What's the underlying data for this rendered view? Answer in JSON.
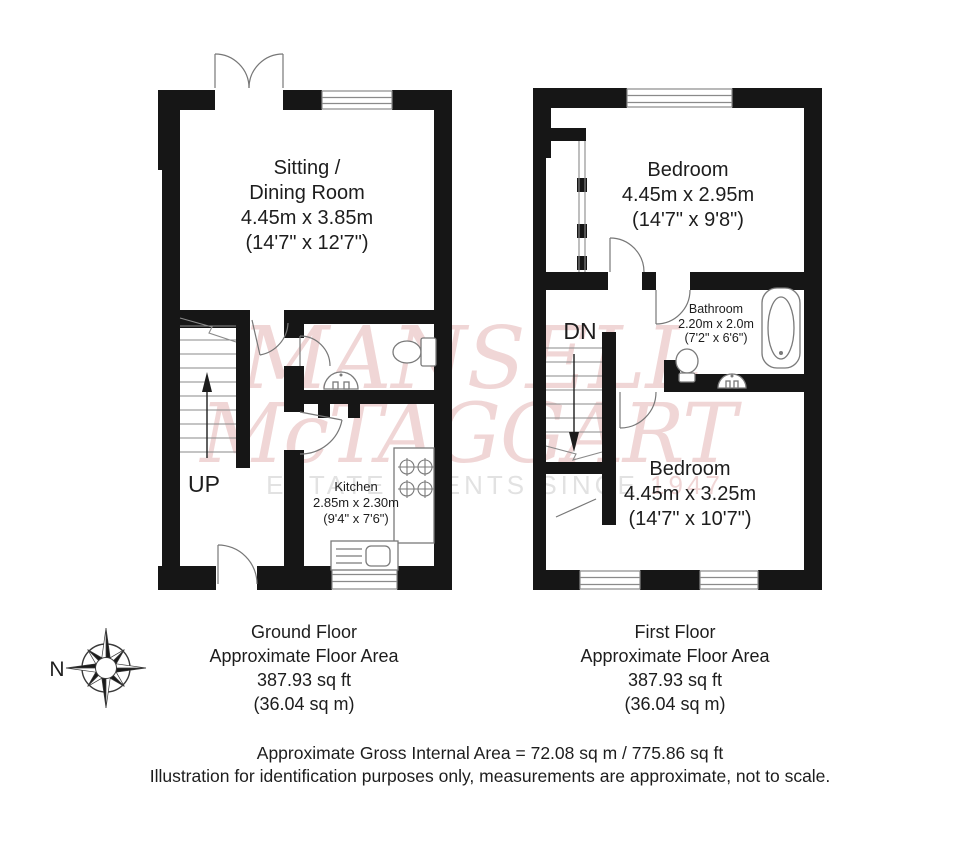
{
  "watermark": {
    "name_line1": "MANSELL",
    "name_line2": "McTAGGART",
    "tagline": "ESTATE AGENTS SINCE ",
    "tagline_year": "1947",
    "name_color": "#f0d6d6",
    "tagline_color": "#e2e2e2"
  },
  "compass": {
    "north_label": "N"
  },
  "colors": {
    "wall": "#161616",
    "linework": "#8a8a8a",
    "text": "#1d1d1d"
  },
  "ground_floor": {
    "sitting_room": {
      "line1": "Sitting /",
      "line2": "Dining Room",
      "metric": "4.45m x 3.85m",
      "imperial": "(14'7\" x 12'7\")"
    },
    "kitchen": {
      "name": "Kitchen",
      "metric": "2.85m x 2.30m",
      "imperial": "(9'4\" x 7'6\")"
    },
    "stairs_label": "UP",
    "caption": {
      "title": "Ground Floor",
      "subtitle": "Approximate Floor Area",
      "area_ft": "387.93 sq ft",
      "area_m": "(36.04 sq m)"
    }
  },
  "first_floor": {
    "bedroom1": {
      "name": "Bedroom",
      "metric": "4.45m x 2.95m",
      "imperial": "(14'7\" x 9'8\")"
    },
    "bathroom": {
      "name": "Bathroom",
      "metric": "2.20m x 2.0m",
      "imperial": "(7'2\" x 6'6\")"
    },
    "bedroom2": {
      "name": "Bedroom",
      "metric": "4.45m x 3.25m",
      "imperial": "(14'7\" x 10'7\")"
    },
    "stairs_label": "DN",
    "caption": {
      "title": "First Floor",
      "subtitle": "Approximate Floor Area",
      "area_ft": "387.93 sq ft",
      "area_m": "(36.04 sq m)"
    }
  },
  "footer": {
    "line1": "Approximate Gross Internal Area  = 72.08 sq m / 775.86 sq ft",
    "line2": "Illustration for identification purposes only, measurements are approximate, not to scale."
  }
}
